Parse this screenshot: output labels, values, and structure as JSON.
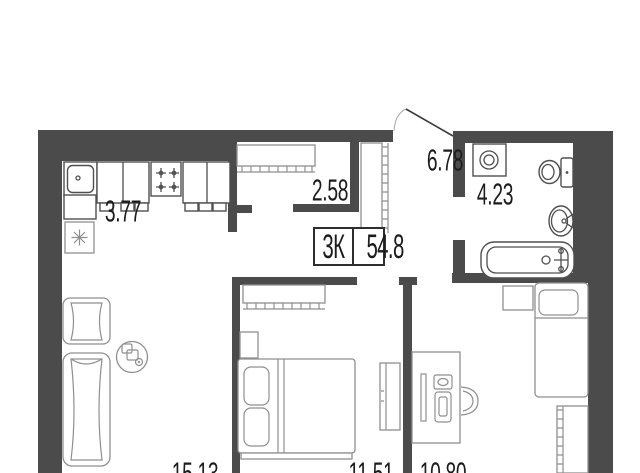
{
  "floor_plan": {
    "badge": {
      "rooms": "3К",
      "area": "54.8"
    },
    "room_labels": {
      "kitchen": "3.77",
      "closet": "2.58",
      "hallway": "6.78",
      "bathroom": "4.23",
      "living_room": "15.13",
      "bedroom": "11.51",
      "study": "10.80"
    },
    "colors": {
      "wall": "#4b4b4b",
      "furniture_line": "#8f8f8f",
      "fixture_line": "#4f4f4f",
      "text": "#1c1c1c",
      "bg": "#ffffff"
    },
    "icon_names": [
      "snowflake-icon",
      "stove-burner-icon",
      "door-swing-icon",
      "washer-drum-icon",
      "monitor-icon",
      "pc-tower-icon"
    ]
  }
}
